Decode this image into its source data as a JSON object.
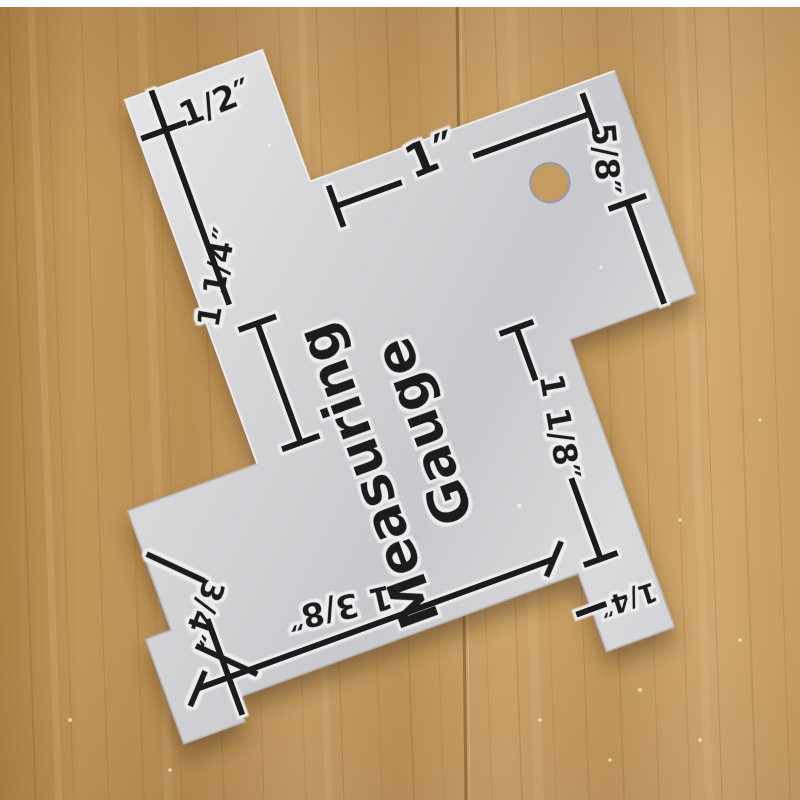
{
  "colors": {
    "ink": "#1c1c1e",
    "wood": "#c49a5f",
    "seam": "#8b6437",
    "plate": "#d8d8db"
  },
  "gauge": {
    "name_line1": "Measuring",
    "name_line2": "Gauge",
    "measurements": {
      "top_left": "1/2″",
      "left": "1 1/4″",
      "top_center": "1″",
      "top_right": "5/8″",
      "right": "1 1/8″",
      "bottom_left": "3/4″",
      "bottom_center": "1 3/8″",
      "bottom_tab": "1/4″"
    }
  }
}
